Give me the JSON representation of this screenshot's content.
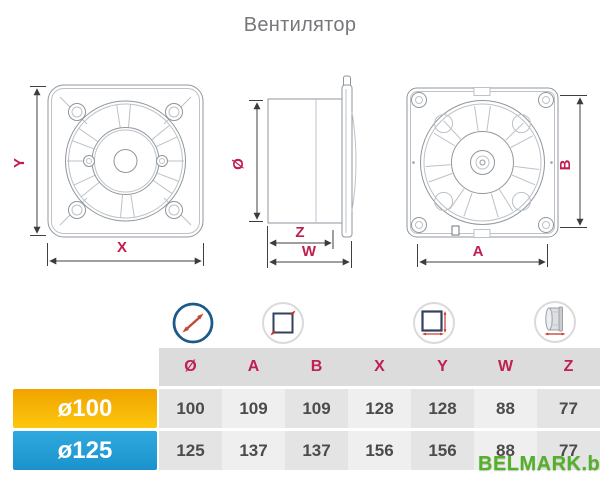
{
  "title": "Вентилятор",
  "drawings": {
    "front_view": {
      "dim_y": "Y",
      "dim_x": "X"
    },
    "side_view": {
      "dim_diameter": "Ø",
      "dim_z": "Z",
      "dim_w": "W"
    },
    "back_view": {
      "dim_b": "B",
      "dim_a": "A"
    }
  },
  "icons": [
    {
      "name": "diameter-icon"
    },
    {
      "name": "plate-diagonal-icon"
    },
    {
      "name": "plate-size-icon"
    },
    {
      "name": "duct-depth-icon"
    }
  ],
  "table": {
    "headers": [
      "Ø",
      "A",
      "B",
      "X",
      "Y",
      "W",
      "Z"
    ],
    "rows": [
      {
        "label": "ø100",
        "values": [
          "100",
          "109",
          "109",
          "128",
          "128",
          "88",
          "77"
        ]
      },
      {
        "label": "ø125",
        "values": [
          "125",
          "137",
          "137",
          "156",
          "156",
          "88",
          "77"
        ]
      }
    ]
  },
  "watermark": "BELMARK.by",
  "colors": {
    "dimension_label": "#bf1e4e",
    "header_text": "#bf2050",
    "row_100_accent": "#f6b000",
    "row_125_accent": "#1e9cd8",
    "watermark_green": "#54b02b",
    "icon_ring_blue": "#1b5a8a",
    "icon_arrow_red": "#c23b2e"
  }
}
